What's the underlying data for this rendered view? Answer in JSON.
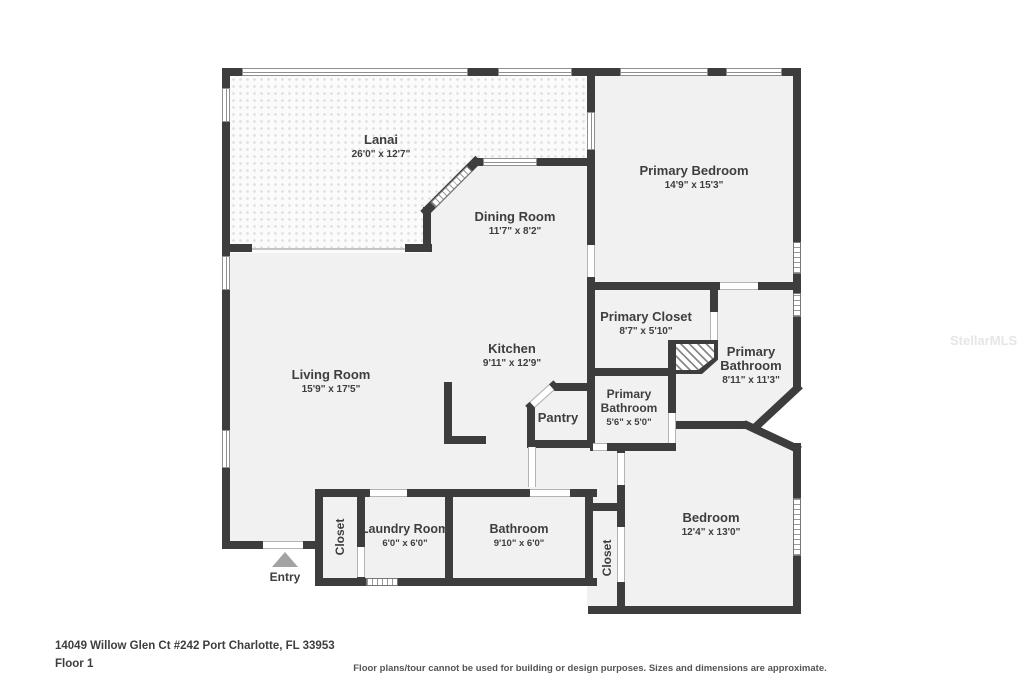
{
  "meta": {
    "address": "14049 Willow Glen Ct #242 Port Charlotte, FL 33953",
    "floor_label": "Floor 1",
    "disclaimer": "Floor plans/tour cannot be used for building or design purposes. Sizes and dimensions are approximate.",
    "watermark": "StellarMLS"
  },
  "rooms": {
    "lanai": {
      "name": "Lanai",
      "dims": "26'0\" x 12'7\""
    },
    "dining_room": {
      "name": "Dining Room",
      "dims": "11'7\" x 8'2\""
    },
    "primary_bedroom": {
      "name": "Primary Bedroom",
      "dims": "14'9\" x 15'3\""
    },
    "primary_closet": {
      "name": "Primary Closet",
      "dims": "8'7\" x 5'10\""
    },
    "primary_bathroom_large": {
      "name_line1": "Primary",
      "name_line2": "Bathroom",
      "dims": "8'11\" x 11'3\""
    },
    "primary_bathroom_small": {
      "name_line1": "Primary",
      "name_line2": "Bathroom",
      "dims": "5'6\" x 5'0\""
    },
    "kitchen": {
      "name": "Kitchen",
      "dims": "9'11\" x 12'9\""
    },
    "pantry": {
      "name": "Pantry"
    },
    "living_room": {
      "name": "Living Room",
      "dims": "15'9\" x 17'5\""
    },
    "entry": {
      "name": "Entry"
    },
    "closet_front": {
      "name": "Closet"
    },
    "laundry_room": {
      "name": "Laundry Room",
      "dims": "6'0\" x 6'0\""
    },
    "bathroom": {
      "name": "Bathroom",
      "dims": "9'10\" x 6'0\""
    },
    "closet_bedroom": {
      "name": "Closet"
    },
    "bedroom": {
      "name": "Bedroom",
      "dims": "12'4\" x 13'0\""
    }
  },
  "colors": {
    "wall": "#3d3d3d",
    "room_fill": "#f1f1f1",
    "label_text": "#3e3e3e",
    "entry_arrow": "#a3a3a3"
  }
}
